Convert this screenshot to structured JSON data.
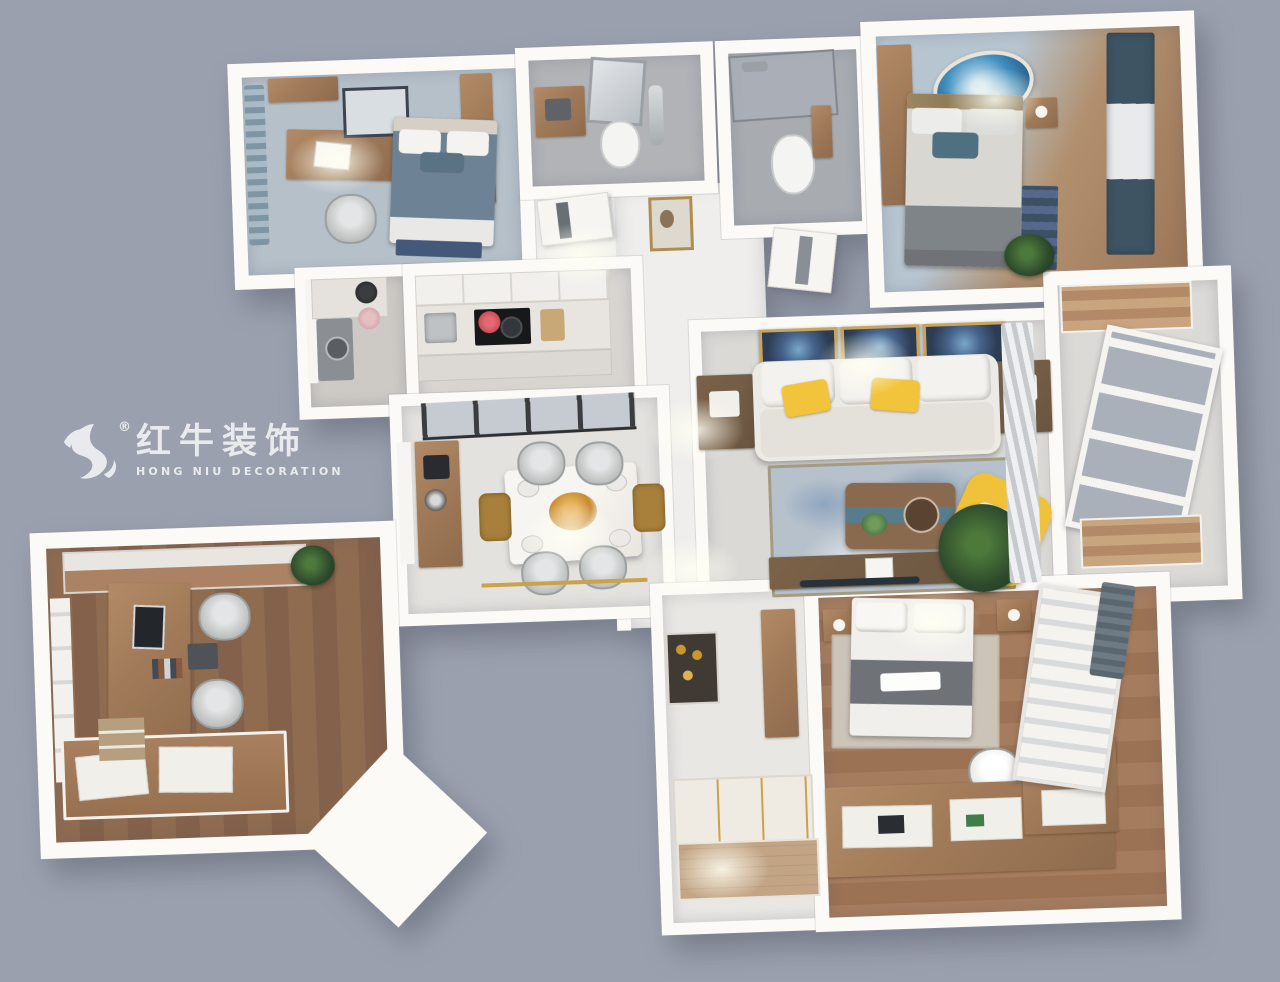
{
  "watermark": {
    "brand_cn": "红牛装饰",
    "brand_en": "HONG NIU DECORATION",
    "registered_mark": "®"
  },
  "palette": {
    "background": "#9aa0ae",
    "wall": "#fbfaf7",
    "corridor_marble": "#efeeec",
    "dining_marble": "#e4e2de",
    "living_marble": "#dbd9d5",
    "tile_gray": "#b2b3b7",
    "tile_dark": "#a8acb1",
    "bedroom_blue_floor": "#b6c0c9",
    "master_blue": "#b7c5d0",
    "wood_light": "#b28a67",
    "wood_mid": "#8f6b4e",
    "wood_dark": "#6a5541",
    "wood_floor": "#9b7254",
    "accent_yellow": "#f2c43c",
    "accent_teal": "#3e5463",
    "rug_blue": "#b6c1cb",
    "rug_navy": "#44597a",
    "art_navy": "#2c3c52",
    "gold": "#c9a24a",
    "plant_green": "#2e4a2c",
    "glass": "#aab0ba"
  },
  "rooms": [
    {
      "id": "secondary-bedroom",
      "furniture": [
        "window-curtain",
        "wall-shelf",
        "desk",
        "laptop",
        "desk-chair",
        "double-bed",
        "wardrobe",
        "wall-art",
        "rug"
      ]
    },
    {
      "id": "laundry-utility",
      "furniture": [
        "window",
        "washing-machine",
        "counter",
        "wok",
        "pot"
      ]
    },
    {
      "id": "kitchen",
      "furniture": [
        "upper-cabinets",
        "counter",
        "sink",
        "cooktop",
        "red-pot",
        "cutting-board"
      ]
    },
    {
      "id": "bathroom-main",
      "furniture": [
        "vanity-cabinet",
        "mirror",
        "toilet",
        "shower-set"
      ]
    },
    {
      "id": "bathroom-second",
      "furniture": [
        "glass-shower",
        "shower-head",
        "toilet",
        "shelf-niche"
      ]
    },
    {
      "id": "master-bedroom",
      "furniture": [
        "wardrobe",
        "round-wall-art",
        "double-bed",
        "teal-pillow",
        "nightstand",
        "rug",
        "plant",
        "window-curtains"
      ]
    },
    {
      "id": "hallway",
      "furniture": [
        "door-bathroom",
        "door-master",
        "gold-framed-art"
      ]
    },
    {
      "id": "living-room",
      "furniture": [
        "wall-art-triptych",
        "sofa",
        "yellow-pillows",
        "side-tables",
        "area-rug",
        "coffee-table",
        "yellow-armchair",
        "tv-console",
        "plant",
        "sheer-curtain"
      ]
    },
    {
      "id": "balcony",
      "furniture": [
        "storage-cabinet-top",
        "window-wall",
        "storage-cabinet-bottom"
      ]
    },
    {
      "id": "dining-room",
      "furniture": [
        "glass-partition",
        "window",
        "sideboard",
        "coffee-machine",
        "marble-dining-table",
        "floral-centerpiece",
        "dining-chairs",
        "gold-armchairs",
        "gold-floor-trim"
      ]
    },
    {
      "id": "study",
      "furniture": [
        "wardrobe-cabinet",
        "plant",
        "window",
        "long-desk",
        "monitor",
        "desk-chairs",
        "wall-shelf",
        "tatami-bed",
        "mattress-pads",
        "photo-wall"
      ]
    },
    {
      "id": "entry-foyer",
      "furniture": [
        "display-niche",
        "tall-cabinet",
        "built-in-closet",
        "shoe-cabinet"
      ]
    },
    {
      "id": "tatami-bedroom",
      "furniture": [
        "nightstands",
        "double-bed",
        "rug",
        "desk-chair",
        "l-shaped-desk-unit",
        "laptop",
        "roman-shade-window",
        "dark-curtain"
      ]
    }
  ]
}
